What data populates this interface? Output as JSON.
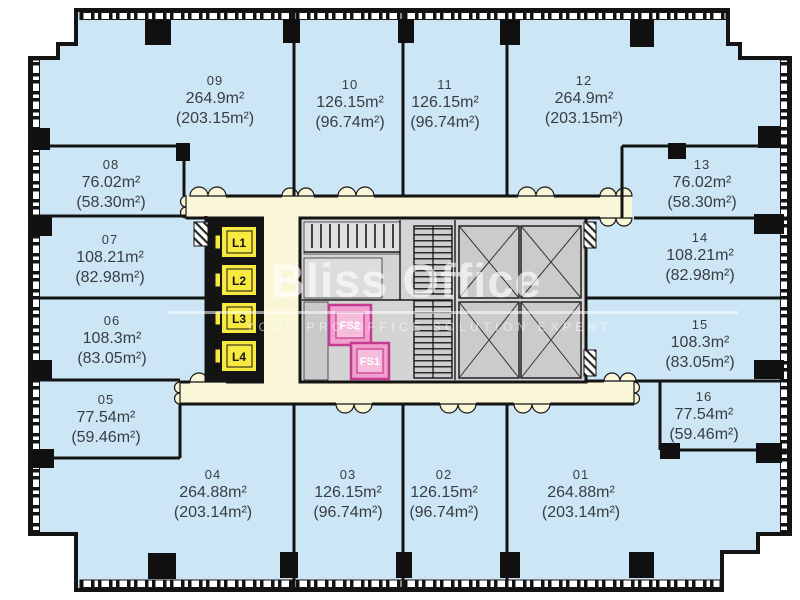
{
  "plan_title": "Office floor plan",
  "watermark": {
    "brand": "Bliss Office",
    "tagline": "YOUR PRO OFFICE SOLUTION EXPERT"
  },
  "rooms": [
    {
      "number": "01",
      "area": "264.88m²",
      "area_alt": "(203.14m²)"
    },
    {
      "number": "02",
      "area": "126.15m²",
      "area_alt": "(96.74m²)"
    },
    {
      "number": "03",
      "area": "126.15m²",
      "area_alt": "(96.74m²)"
    },
    {
      "number": "04",
      "area": "264.88m²",
      "area_alt": "(203.14m²)"
    },
    {
      "number": "05",
      "area": "77.54m²",
      "area_alt": "(59.46m²)"
    },
    {
      "number": "06",
      "area": "108.3m²",
      "area_alt": "(83.05m²)"
    },
    {
      "number": "07",
      "area": "108.21m²",
      "area_alt": "(82.98m²)"
    },
    {
      "number": "08",
      "area": "76.02m²",
      "area_alt": "(58.30m²)"
    },
    {
      "number": "09",
      "area": "264.9m²",
      "area_alt": "(203.15m²)"
    },
    {
      "number": "10",
      "area": "126.15m²",
      "area_alt": "(96.74m²)"
    },
    {
      "number": "11",
      "area": "126.15m²",
      "area_alt": "(96.74m²)"
    },
    {
      "number": "12",
      "area": "264.9m²",
      "area_alt": "(203.15m²)"
    },
    {
      "number": "13",
      "area": "76.02m²",
      "area_alt": "(58.30m²)"
    },
    {
      "number": "14",
      "area": "108.21m²",
      "area_alt": "(82.98m²)"
    },
    {
      "number": "15",
      "area": "108.3m²",
      "area_alt": "(83.05m²)"
    },
    {
      "number": "16",
      "area": "77.54m²",
      "area_alt": "(59.46m²)"
    }
  ],
  "core": {
    "elevators": [
      "L1",
      "L2",
      "L3",
      "L4"
    ],
    "fire_stairs": [
      "FS2",
      "FS1"
    ]
  },
  "colors": {
    "room_fill": "#cde6f5",
    "corridor": "#faf7d8",
    "core_fill": "#d4d4d4",
    "elevator_yellow": "#f7e93f",
    "fire_stair_pink": "#f19fcd",
    "fire_stair_border": "#c43b8f",
    "wall": "#141414"
  }
}
